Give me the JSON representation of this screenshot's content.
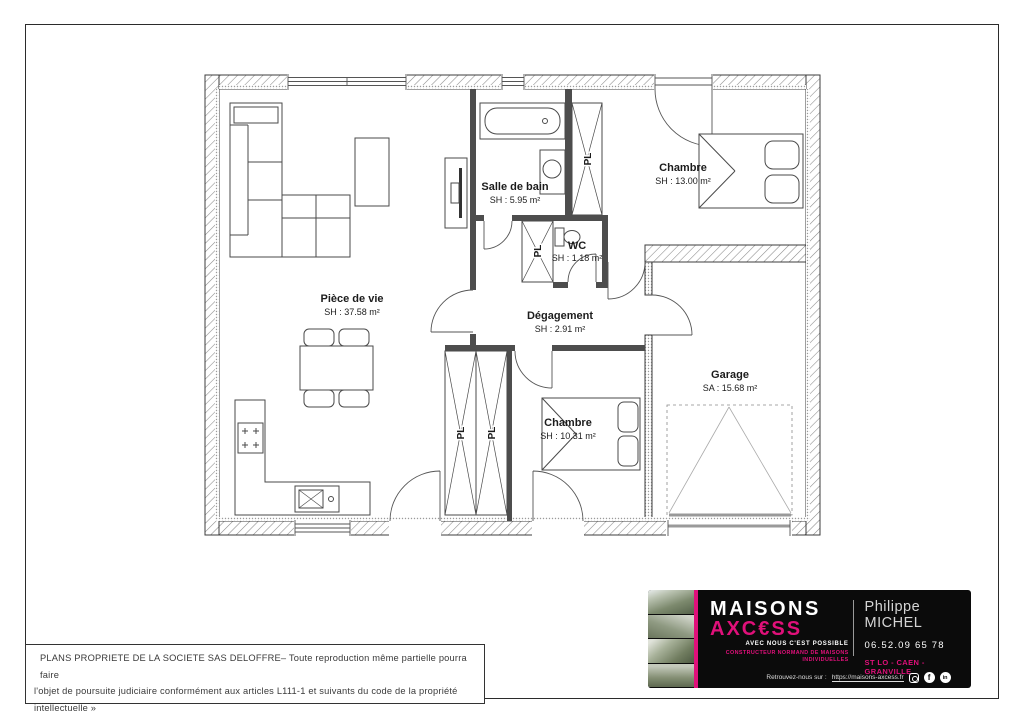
{
  "plan": {
    "rooms": {
      "piece_de_vie": {
        "name": "Pièce de vie",
        "area": "SH : 37.58 m²"
      },
      "salle_de_bain": {
        "name": "Salle de bain",
        "area": "SH : 5.95 m²"
      },
      "wc": {
        "name": "WC",
        "area": "SH : 1.18 m²"
      },
      "chambre1": {
        "name": "Chambre",
        "area": "SH : 13.00 m²"
      },
      "degagement": {
        "name": "Dégagement",
        "area": "SH : 2.91 m²"
      },
      "chambre2": {
        "name": "Chambre",
        "area": "SH : 10.31 m²"
      },
      "garage": {
        "name": "Garage",
        "area": "SA : 15.68 m²"
      }
    },
    "closet_label": "PL"
  },
  "legal": {
    "line1": "PLANS PROPRIETE DE LA SOCIETE SAS DELOFFRE– Toute reproduction même partielle pourra faire",
    "line2": "l'objet de poursuite judiciaire conformément aux articles L111-1 et suivants du code de la propriété",
    "line3": "intellectuelle »"
  },
  "card": {
    "brand_top": "MAISONS",
    "brand_bottom": "AXC€SS",
    "tagline": "AVEC NOUS C'EST POSSIBLE",
    "descriptor_line1": "CONSTRUCTEUR NORMAND DE MAISONS",
    "descriptor_line2": "INDIVIDUELLES",
    "contact_name": "Philippe MICHEL",
    "phone": "06.52.09 65 78",
    "cities": "ST LO - CAEN - GRANVILLE",
    "footer_prefix": "Retrouvez-nous sur :",
    "footer_url": "https://maisons-axcess.fr",
    "social": {
      "icons": [
        "instagram",
        "facebook",
        "linkedin"
      ],
      "facebook_glyph": "f",
      "linkedin_glyph": "in"
    },
    "colors": {
      "pink": "#e0107a",
      "black": "#0b0b0b"
    }
  }
}
